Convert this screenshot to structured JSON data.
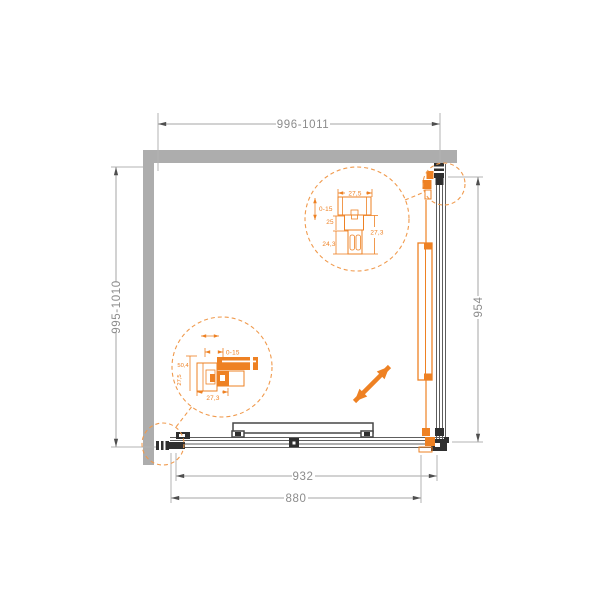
{
  "drawing": {
    "type": "shower-enclosure-installation-plan",
    "dimensions": {
      "width_top": "996-1011",
      "depth_left": "995-1010",
      "side_panel_right": "954",
      "bottom_outer": "932",
      "bottom_inner": "880"
    },
    "detail_top_right": {
      "profile_width": "27,5",
      "adjustment_range": "0-15",
      "offset": "25",
      "channel_depth": "24,3",
      "profile_depth": "27,3"
    },
    "detail_bottom_left": {
      "adjustment_range": "0-15",
      "profile_height": "50,4",
      "profile_inner": "27,5",
      "profile_width": "27,3"
    },
    "colors": {
      "accent_orange": "#ee8123",
      "wall_gray": "#adadad",
      "hardware_black": "#2f2f2f",
      "dimension_text": "#8c8c8c",
      "dimension_line": "#a6a6a6",
      "panel_line": "#5e5e5e"
    }
  }
}
